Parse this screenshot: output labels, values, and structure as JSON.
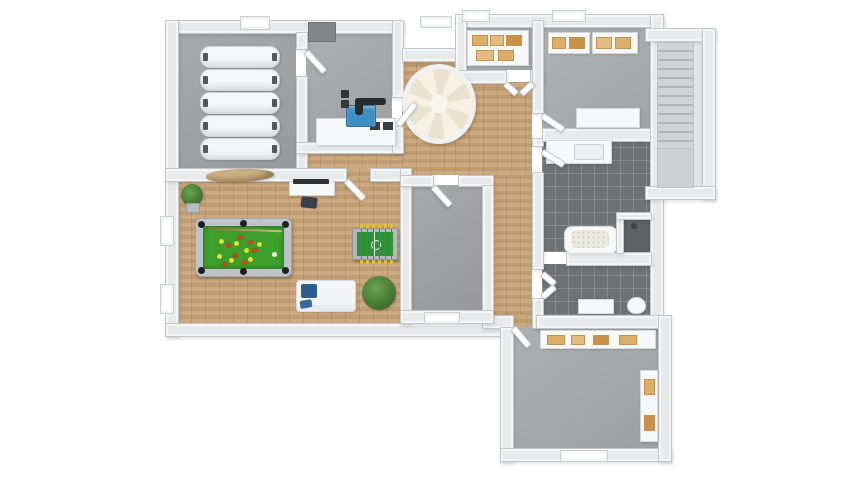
{
  "scene": {
    "kind": "3d-floorplan-top-down-render",
    "floor_level": "basement",
    "canvas": {
      "width": 850,
      "height": 478,
      "background": "#ffffff"
    }
  },
  "palette": {
    "wall_fill": "#e7e9eb",
    "wall_edge": "#c3c5c7",
    "concrete": "#a6a8aa",
    "concrete_dark": "#9fa1a3",
    "concrete_light": "#aaacae",
    "wood": "#c8a377",
    "tile_dark": "#6f7274",
    "stairwell_floor": "#e2e3e4",
    "spiral_stair_cream": "#f6f1e3",
    "pool_felt": "#3ca02b",
    "pool_frame": "#bfc2c6",
    "ball_red": "#d4411f",
    "ball_yellow": "#e8e035",
    "cue_ball": "#ffffff",
    "foosball_green": "#2e9038",
    "boiler_blue": "#3e8fc4",
    "pipe_black": "#292b2c",
    "plant_green": "#4f8a3c",
    "sofa_white": "#f3f4f5",
    "cushion_blue": "#2d5e8e",
    "shelf_item_tan": "#dcae66",
    "tank_white": "#f5f6f7",
    "driftwood_tan": "#cbb185"
  },
  "rooms": [
    {
      "id": "tank-room",
      "floor": "concrete",
      "items": [
        "storage-tank",
        "storage-tank",
        "storage-tank",
        "storage-tank",
        "storage-tank"
      ]
    },
    {
      "id": "boiler-room",
      "floor": "concrete",
      "items": [
        "boiler",
        "pipework",
        "counter-unit"
      ]
    },
    {
      "id": "hallway",
      "floor": "wood",
      "items": [
        "spiral-staircase"
      ]
    },
    {
      "id": "storage-room-small",
      "floor": "concrete",
      "items": [
        "shelving-unit"
      ]
    },
    {
      "id": "storage-room-large",
      "floor": "concrete",
      "items": [
        "shelving-unit",
        "shelving-unit",
        "work-table"
      ]
    },
    {
      "id": "stairwell",
      "floor": "concrete",
      "items": [
        "straight-staircase",
        "landing"
      ]
    },
    {
      "id": "bathroom",
      "floor": "dark-tile",
      "items": [
        "vanity-sink",
        "bathtub",
        "corner-shower"
      ]
    },
    {
      "id": "wc-room",
      "floor": "dark-tile",
      "items": [
        "toilet",
        "cabinet"
      ]
    },
    {
      "id": "utility-room",
      "floor": "concrete",
      "items": []
    },
    {
      "id": "recreation-room",
      "floor": "wood",
      "items": [
        "pool-table",
        "foosball-table",
        "sofa",
        "tv-sideboard",
        "potted-plant",
        "potted-plant",
        "driftwood-decor"
      ]
    },
    {
      "id": "basement-room",
      "floor": "concrete",
      "items": [
        "sideboard",
        "tall-shelf"
      ]
    }
  ],
  "pool_table": {
    "felt": "#3ca02b",
    "red_balls": 7,
    "yellow_balls": 7,
    "cue_ball": 1,
    "pockets": 6,
    "cue_stick": 1
  },
  "foosball_table": {
    "field": "#2e9038",
    "rods": 6,
    "handle_color": "#e3c31f"
  },
  "openings": {
    "windows": 7,
    "door_leaves": 11,
    "wall_niche": 1
  }
}
